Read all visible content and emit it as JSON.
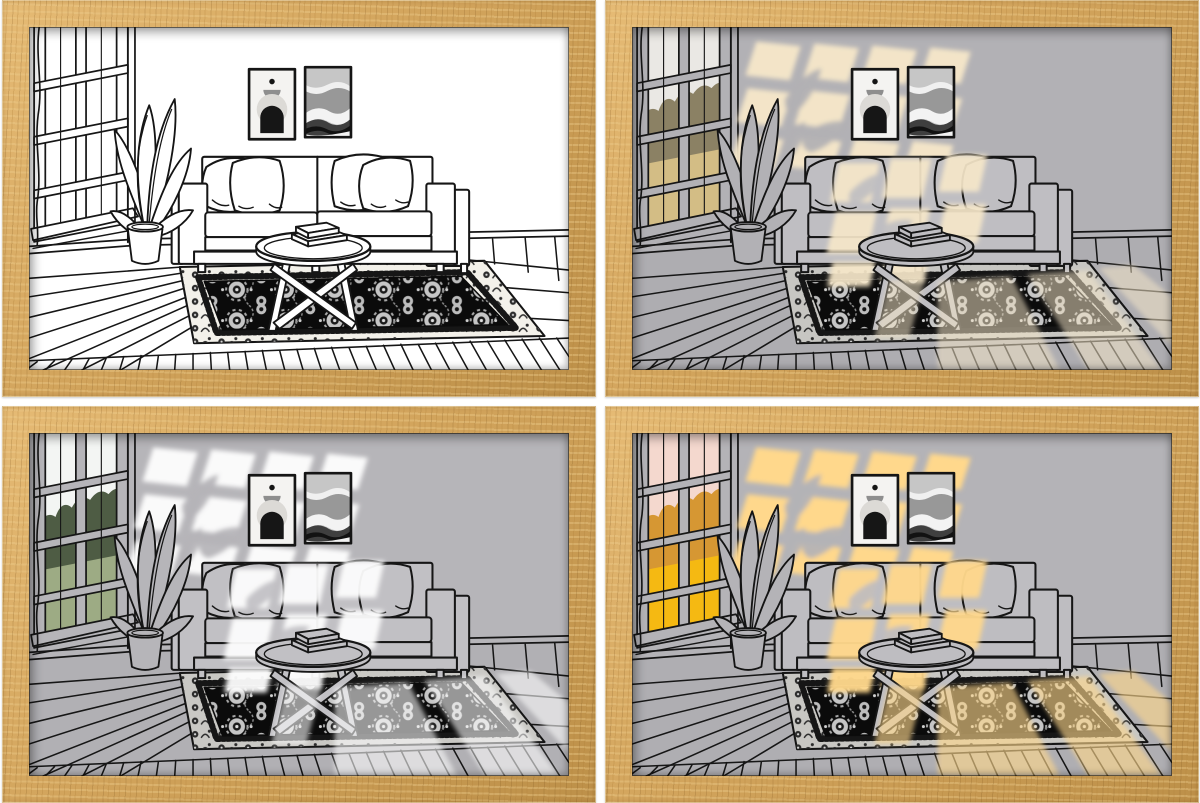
{
  "meta": {
    "description": "Product collage: four identical oak-framed prints of a line-art living room shown in four lighting modes",
    "background_color": "#ffffff"
  },
  "theme": {
    "style_vars": "--wood-light:#e6bb75;--wood-mid:#d2a45c;--wood-dark:#bd9049",
    "frame_wood_color": "#d2a45c",
    "line_color": "#161616"
  },
  "scene": {
    "elements": [
      "window",
      "curtain-edge",
      "window-landscape",
      "potted-plant",
      "poster-abstract-figure",
      "poster-abstract-waves",
      "sofa",
      "throw-pillows",
      "coffee-table",
      "stacked-books",
      "oriental-rug",
      "wood-plank-floor",
      "sunlight-window-patches"
    ]
  },
  "panels": [
    {
      "id": "top-left",
      "mode": "line-art-off",
      "style_vars": "--wall:#ffffff;--floor:#ffffff;--sofa:#ffffff;--rugB:#f3f1ea;--light:transparent;--wLo:0;--sLo:0;--fLo:0;--sky:#ffffff;--trees:#ffffff;--grass:#ffffff",
      "light_color": "none",
      "window_view": {
        "sky": "#ffffff",
        "trees": "#ffffff",
        "ground": "#ffffff"
      }
    },
    {
      "id": "top-right",
      "mode": "warm-daylight",
      "style_vars": "--wall:#b2b1b5;--floor:#aeadb1;--sofa:#bfbec2;--rugB:#c7c6c2;--light:#f6e7c9;--wLo:.96;--sLo:.92;--fLo:.52;--sky:#eae8e4;--trees:#8b8164;--grass:#d3bd85",
      "light_color": "#f6e7c9",
      "window_view": {
        "sky": "#eae8e4",
        "trees": "#8b8164",
        "ground": "#d3bd85"
      }
    },
    {
      "id": "bottom-left",
      "mode": "cool-white",
      "style_vars": "--wall:#b6b5b9;--floor:#b1b0b4;--sofa:#c1c0c4;--rugB:#c9c8c4;--light:#fdfdfd;--wLo:.97;--sLo:.95;--fLo:.58;--sky:#f3f5f3;--trees:#4e5c44;--grass:#9dab84",
      "light_color": "#fdfdfd",
      "window_view": {
        "sky": "#f3f5f3",
        "trees": "#4e5c44",
        "ground": "#9dab84"
      }
    },
    {
      "id": "bottom-right",
      "mode": "golden-hour",
      "style_vars": "--wall:#b4b3b7;--floor:#afaeb2;--sofa:#bebdc1;--rugB:#c8c7c3;--light:#ffd88c;--wLo:1;--sLo:.96;--fLo:.62;--sky:#f4d8ce;--trees:#d69733;--grass:#f5b912",
      "light_color": "#ffd88c",
      "window_view": {
        "sky": "#f4d8ce",
        "trees": "#d69733",
        "ground": "#f5b912"
      }
    }
  ]
}
